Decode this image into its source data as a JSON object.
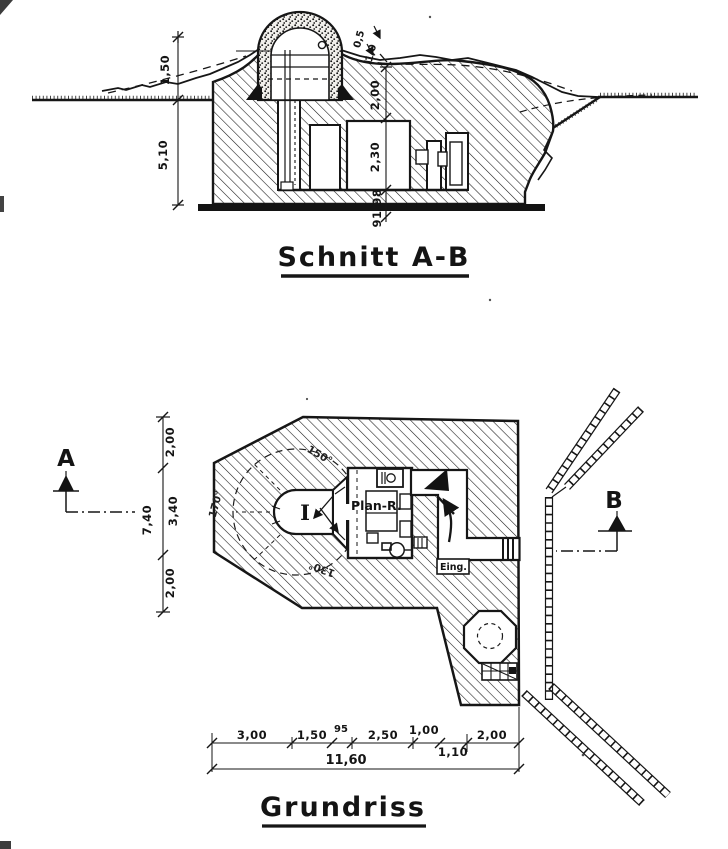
{
  "drawing": {
    "section": {
      "title": "Schnitt A-B",
      "dims": {
        "mound_height": "1,50",
        "wall_depth": "5,10",
        "cover_top_1": "0,5",
        "cover_top_2": "1,0",
        "roof_thickness": "2,00",
        "room_height": "2,30",
        "floor_level": "91,98"
      }
    },
    "plan": {
      "title": "Grundriss",
      "section_marker_a": "A",
      "section_marker_b": "B",
      "labels": {
        "plan_room": "Plan-R.",
        "entrance": "Eing.",
        "turret": "I"
      },
      "angles": {
        "top": "150°",
        "left": "170°",
        "bottom": "130°"
      },
      "dims_left": {
        "top": "2,00",
        "middle": "3,40",
        "bottom": "2,00",
        "total": "7,40"
      },
      "dims_bottom": {
        "seg_1": "3,00",
        "seg_2": "1,50",
        "seg_3": "95",
        "seg_4": "2,50",
        "seg_5": "1,00",
        "seg_6": "1,10",
        "seg_7": "2,00",
        "total": "11,60"
      }
    }
  }
}
